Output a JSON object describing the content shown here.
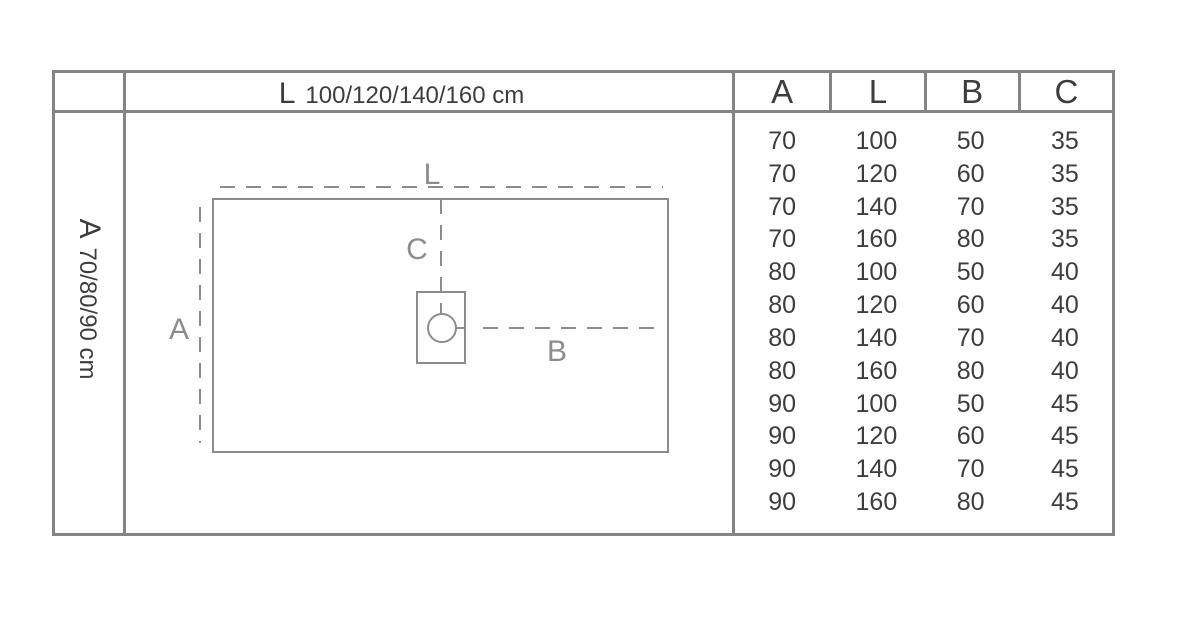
{
  "title_row": {
    "length_letter": "L",
    "length_values": "100/120/140/160 cm"
  },
  "side_column": {
    "width_letter": "A",
    "width_values": "70/80/90 cm"
  },
  "spec_table": {
    "columns": [
      "A",
      "L",
      "B",
      "C"
    ],
    "rows": [
      [
        "70",
        "100",
        "50",
        "35"
      ],
      [
        "70",
        "120",
        "60",
        "35"
      ],
      [
        "70",
        "140",
        "70",
        "35"
      ],
      [
        "70",
        "160",
        "80",
        "35"
      ],
      [
        "80",
        "100",
        "50",
        "40"
      ],
      [
        "80",
        "120",
        "60",
        "40"
      ],
      [
        "80",
        "140",
        "70",
        "40"
      ],
      [
        "80",
        "160",
        "80",
        "40"
      ],
      [
        "90",
        "100",
        "50",
        "45"
      ],
      [
        "90",
        "120",
        "60",
        "45"
      ],
      [
        "90",
        "140",
        "70",
        "45"
      ],
      [
        "90",
        "160",
        "80",
        "45"
      ]
    ]
  },
  "diagram": {
    "length_label": "L",
    "width_label": "A",
    "drain_offset_label": "B",
    "drain_center_label": "C"
  },
  "colors": {
    "border": "#848484",
    "text": "#3d3d3d",
    "diagram_gray": "#8c8c8c"
  }
}
